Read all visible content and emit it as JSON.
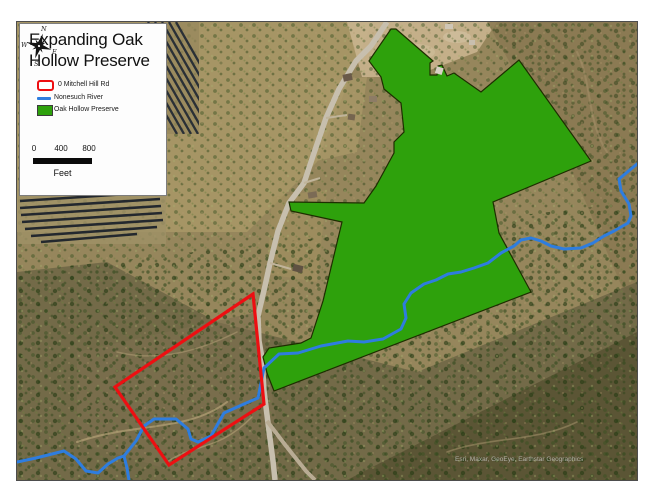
{
  "legend": {
    "title_line1": "Expanding Oak",
    "title_line2": "Hollow Preserve",
    "items": [
      {
        "label": "0 Mitchell Hill Rd",
        "swatch": "red-outline-polygon",
        "color": "#ed0f12"
      },
      {
        "label": "Nonesuch River",
        "swatch": "blue-line",
        "color": "#2e7ddf"
      },
      {
        "label": "Oak Hollow Preserve",
        "swatch": "green-fill-polygon",
        "color": "#2ea10c"
      }
    ],
    "scale": {
      "ticks": [
        "0",
        "400",
        "800"
      ],
      "unit": "Feet"
    },
    "compass": {
      "n": "N",
      "e": "E",
      "s": "S",
      "w": "W"
    }
  },
  "map": {
    "attribution": "Esri, Maxar, GeoEye, Earthstar Geographics",
    "colors": {
      "preserve_fill": "#2ea10c",
      "parcel_outline": "#ed0f12",
      "river": "#2e7ddf",
      "road": "#c7bfae"
    }
  }
}
